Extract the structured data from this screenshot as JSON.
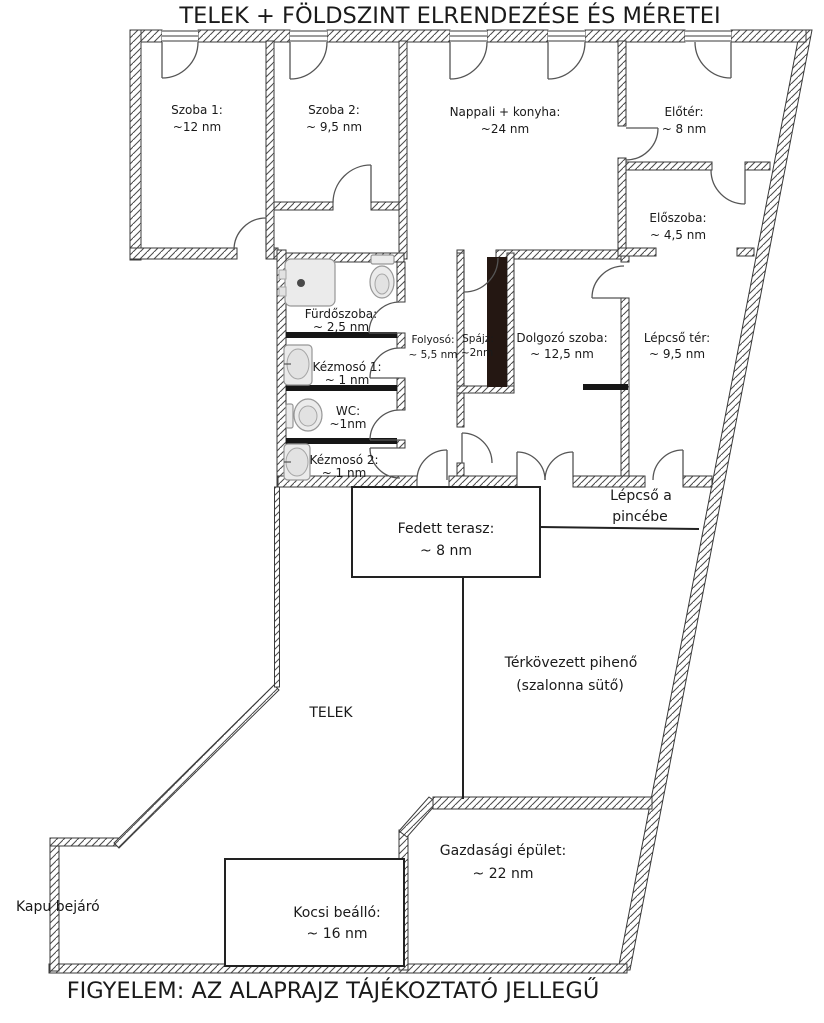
{
  "page": {
    "title": "TELEK + FÖLDSZINT ELRENDEZÉSE ÉS MÉRETEI",
    "footer": "FIGYELEM: AZ ALAPRAJZ TÁJÉKOZTATÓ JELLEGŰ"
  },
  "rooms": {
    "szoba1": {
      "name": "Szoba 1:",
      "area": "~12 nm"
    },
    "szoba2": {
      "name": "Szoba 2:",
      "area": "~ 9,5 nm"
    },
    "nappali": {
      "name": "Nappali + konyha:",
      "area": "~24 nm"
    },
    "eloter": {
      "name": "Előtér:",
      "area": "~ 8 nm"
    },
    "eloszoba": {
      "name": "Előszoba:",
      "area": "~ 4,5 nm"
    },
    "furdoszoba": {
      "name": "Fürdőszoba:",
      "area": "~ 2,5 nm"
    },
    "kezmoso1": {
      "name": "Kézmosó 1:",
      "area": "~ 1 nm"
    },
    "wc": {
      "name": "WC:",
      "area": "~1nm"
    },
    "kezmoso2": {
      "name": "Kézmosó 2:",
      "area": "~ 1 nm"
    },
    "folyoso": {
      "name": "Folyosó:",
      "area": "~ 5,5 nm"
    },
    "spajz": {
      "name": "Spájz:",
      "area": "~2nm"
    },
    "dolgozo_szoba": {
      "name": "Dolgozó szoba:",
      "area": "~ 12,5 nm"
    },
    "lepcso_ter": {
      "name": "Lépcső tér:",
      "area": "~ 9,5 nm"
    },
    "fedett_terasz": {
      "name": "Fedett terasz:",
      "area": "~ 8 nm"
    }
  },
  "outdoor": {
    "lepcso_pince_1": "Lépcső a",
    "lepcso_pince_2": "pincébe",
    "terkovezett_1": "Térkövezett pihenő",
    "terkovezett_2": "(szalonna sütő)",
    "telek": "TELEK",
    "gazdasagi": {
      "name": "Gazdasági épület:",
      "area": "~ 22 nm"
    },
    "kocsi": {
      "name": "Kocsi beálló:",
      "area": "~ 16 nm"
    },
    "kapubejaro": "Kapu bejáró"
  },
  "fixtures": [
    "shower-tray",
    "toilet",
    "washbasin",
    "toilet",
    "washbasin"
  ],
  "colors": {
    "wall_hatch": "#4a4a4a",
    "wall_outline": "#3a3a3a",
    "line": "#222222",
    "door_arc": "#555555",
    "pantry_strip": "#241712",
    "fixture_fill": "#ebebeb",
    "fixture_stroke": "#979797",
    "text": "#1a1a1a"
  }
}
